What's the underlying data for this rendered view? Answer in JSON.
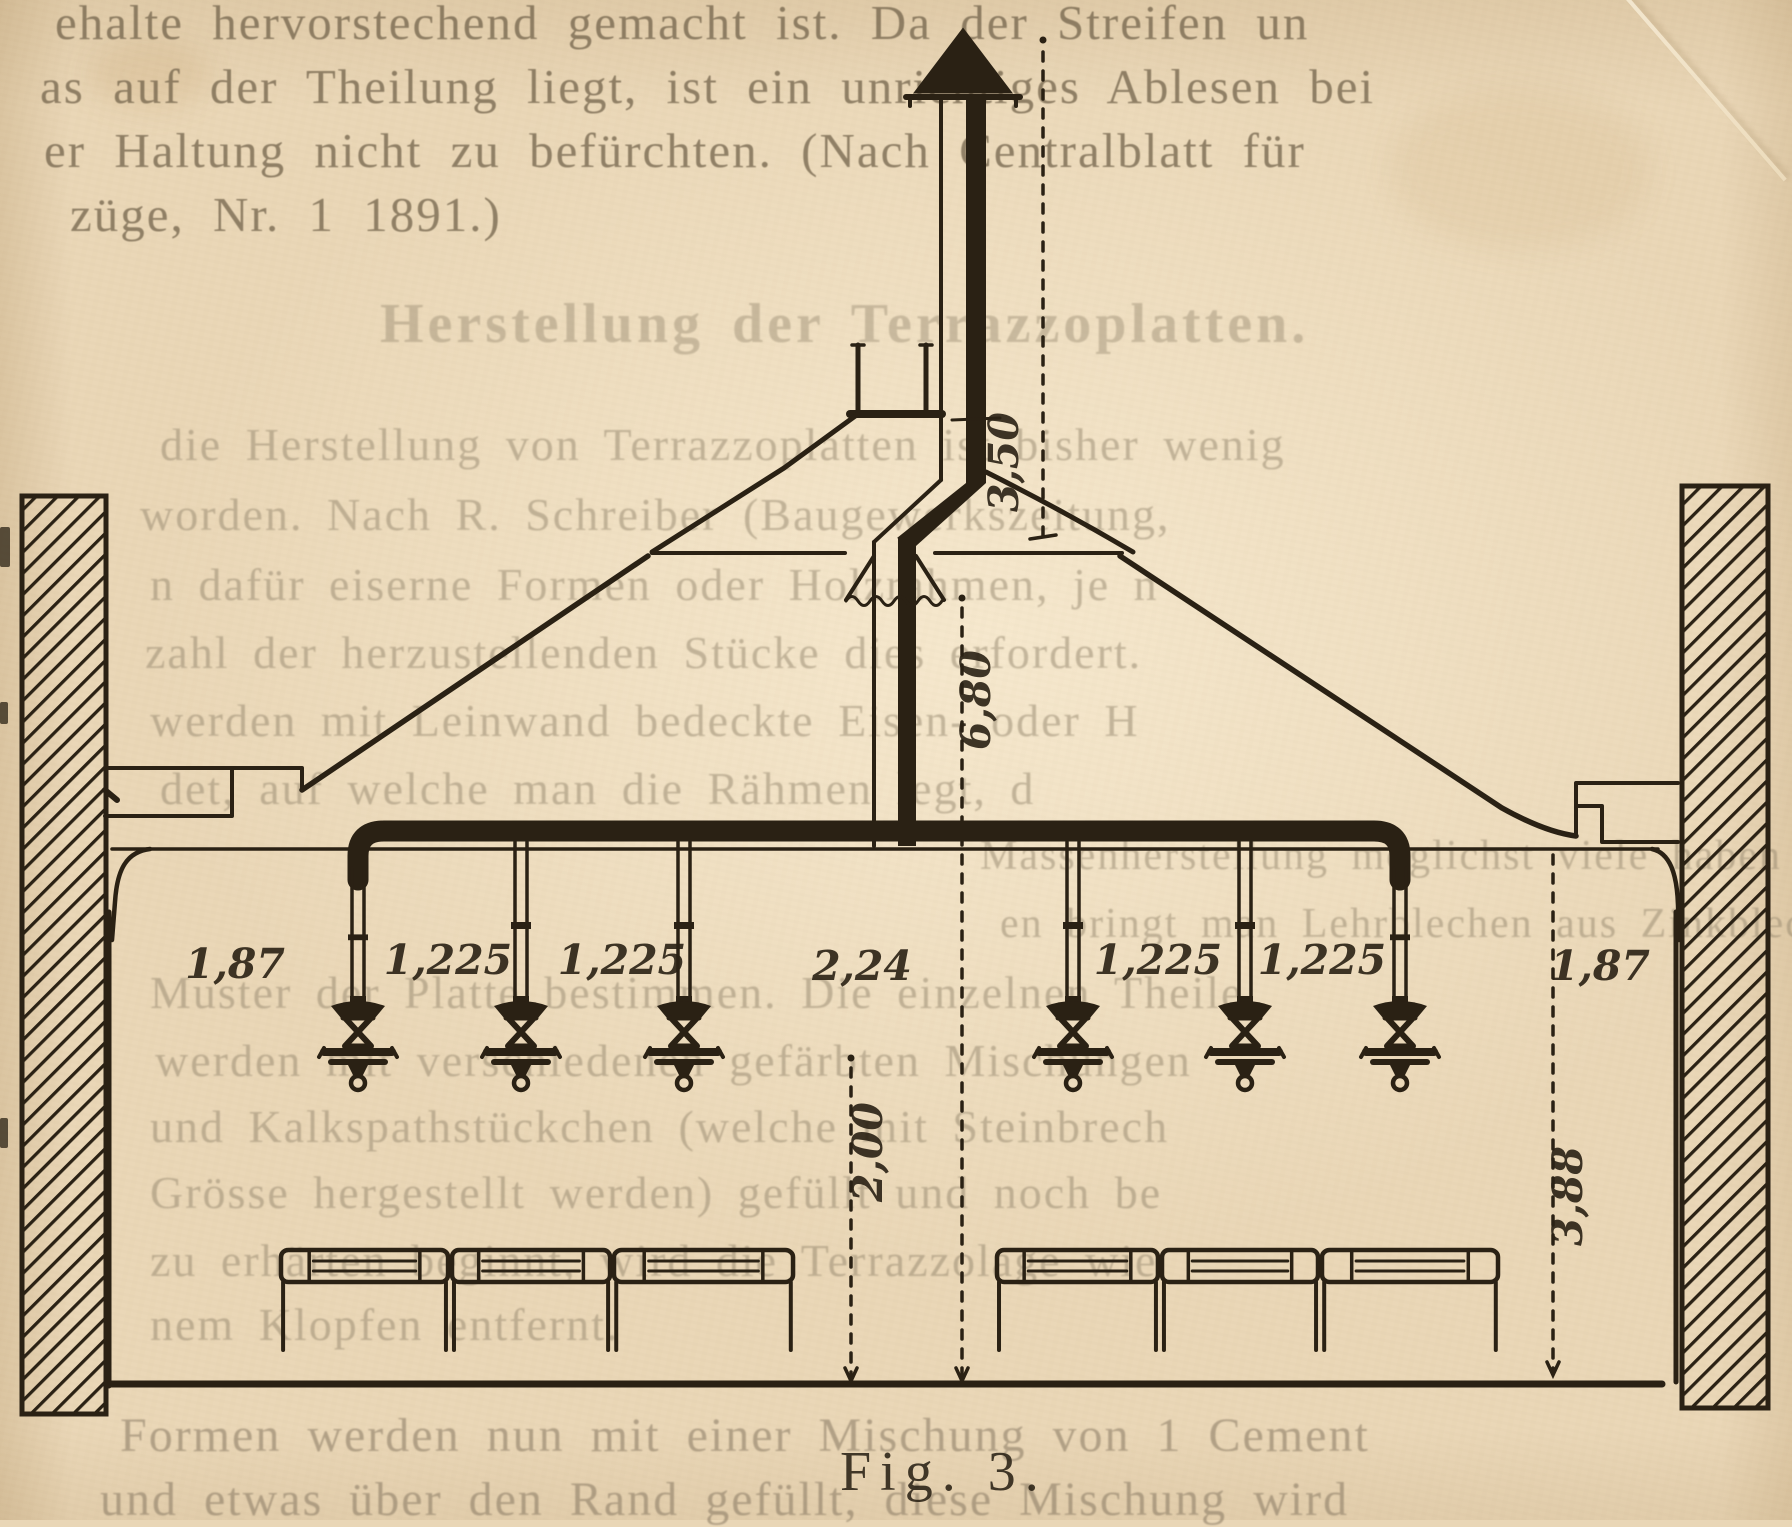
{
  "page": {
    "top_lines": [
      "ehalte hervorstechend gemacht ist.  Da der Streifen un",
      "as auf der Theilung liegt, ist ein unrichtiges Ablesen bei",
      "er Haltung nicht zu befürchten.  (Nach Centralblatt für",
      "züge, Nr. 1 1891.)"
    ],
    "ghost_heading": "Herstellung der Terrazzoplatten.",
    "ghost_body_lines": [
      "die Herstellung von Terrazzoplatten ist bisher wenig",
      "worden.  Nach R. Schreiber (Baugewerkszeitung,",
      "n dafür eiserne Formen oder Holzrahmen, je n",
      "zahl der herzustellenden Stücke dies erfordert.",
      "werden mit Leinwand bedeckte Eisen- oder H",
      "det, auf welche man die Rähmen legt, d",
      "Massenherstellung möglichst viele haben muss,",
      "en bringt man Lehrblechen aus Zinkblech",
      "Muster der Platte bestimmen.  Die einzelnen Theile",
      "werden mit verschiedenen gefärbten Mischungen",
      "und Kalkspathstückchen (welche mit Steinbrech",
      "Grösse hergestellt werden) gefüllt und noch be",
      "zu erhärten beginnt, wird die Terrazzolage wie",
      "nem Klopfen entfernt."
    ],
    "bottom_lines": [
      "Formen werden nun mit einer Mischung von 1 Cement",
      "und etwas über den Rand gefüllt, diese Mischung wird"
    ],
    "caption": "Fig. 3."
  },
  "figure": {
    "type": "engraved cross-section of a hall with ventilation chimney and gas lamps",
    "ink_color": "#2a2114",
    "paper_color": "#e9d6b6",
    "dimensions": {
      "chimney_height": "3,50",
      "shaft_height": "6,80",
      "lamp_clearance": "2,00",
      "room_height": "3,88",
      "spacing_left_wall": "1,87",
      "spacing_1": "1,225",
      "spacing_2": "1,225",
      "spacing_center": "2,24",
      "spacing_3": "1,225",
      "spacing_4": "1,225",
      "spacing_right_wall": "1,87"
    }
  }
}
